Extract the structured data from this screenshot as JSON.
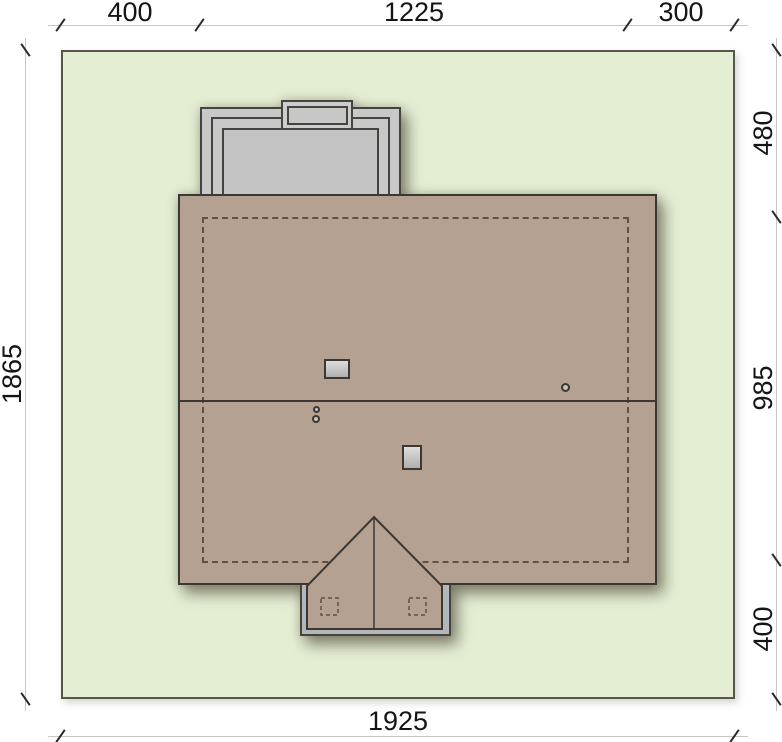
{
  "drawing": {
    "type": "architectural-site-plan",
    "dimensions": {
      "top": [
        {
          "label": "400"
        },
        {
          "label": "1225"
        },
        {
          "label": "300"
        }
      ],
      "right": [
        {
          "label": "480"
        },
        {
          "label": "985"
        },
        {
          "label": "400"
        }
      ],
      "left": [
        {
          "label": "1865"
        }
      ],
      "bottom": [
        {
          "label": "1925"
        }
      ]
    },
    "colors": {
      "plot_green": "#e3eed3",
      "roof_brown": "#b4a191",
      "structure_gray": "#c8c8c8",
      "terrace_gray": "#b4b7ba",
      "outline_dark": "#3b3733",
      "dashed_line": "#5f5147",
      "dimension_line": "#c6c6c6",
      "dimension_text": "#151515",
      "background": "#ffffff"
    }
  }
}
